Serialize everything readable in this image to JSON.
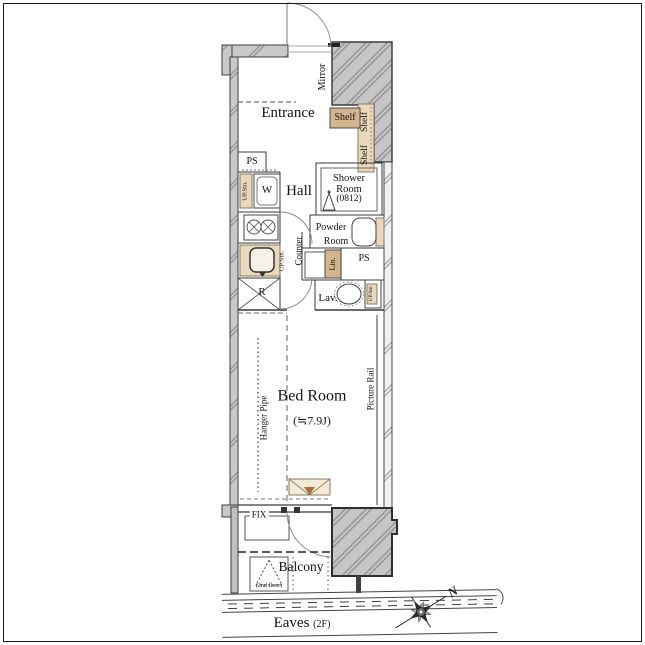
{
  "colors": {
    "wall_gray": "#c6c6c6",
    "hatch_line": "#8d8d8d",
    "tan_light": "#ead8ba",
    "tan_dark": "#d4b58e",
    "line_dark": "#3a3a3a",
    "background": "#ffffff"
  },
  "rooms": {
    "entrance": {
      "label": "Entrance"
    },
    "hall": {
      "label": "Hall"
    },
    "shower_room": {
      "label": "Shower Room",
      "size": "(0812)"
    },
    "powder_room": {
      "line1": "Powder",
      "line2": "Room"
    },
    "lavatory": {
      "label": "Lav."
    },
    "bed_room": {
      "label": "Bed Room",
      "size": "(≒7.9J)"
    },
    "balcony": {
      "label": "Balcony"
    }
  },
  "fixtures": {
    "mirror": "Mirror",
    "shelf_top": "Shelf",
    "shelf_side_upper": "Shelf",
    "shelf_side_lower": "Shelf",
    "pipe_space_left": "PS",
    "pipe_space_right": "PS",
    "washer": "W",
    "washer_upper_storage": "UP.Stn.",
    "counter": "Counter",
    "linen": "Lin.",
    "kitchen_upper_storage": "UP/Stn.",
    "refrigerator": "R",
    "toilet_upper_storage": "UP.Stn",
    "hanger_pipe": "Hanger Pipe",
    "picture_rail": "Picture Rail",
    "fix_window": "FIX",
    "evac_hatch_note": "(2nd floor)"
  },
  "annotations": {
    "eaves": "Eaves",
    "eaves_floor": "(2F)",
    "compass_north": "N"
  }
}
